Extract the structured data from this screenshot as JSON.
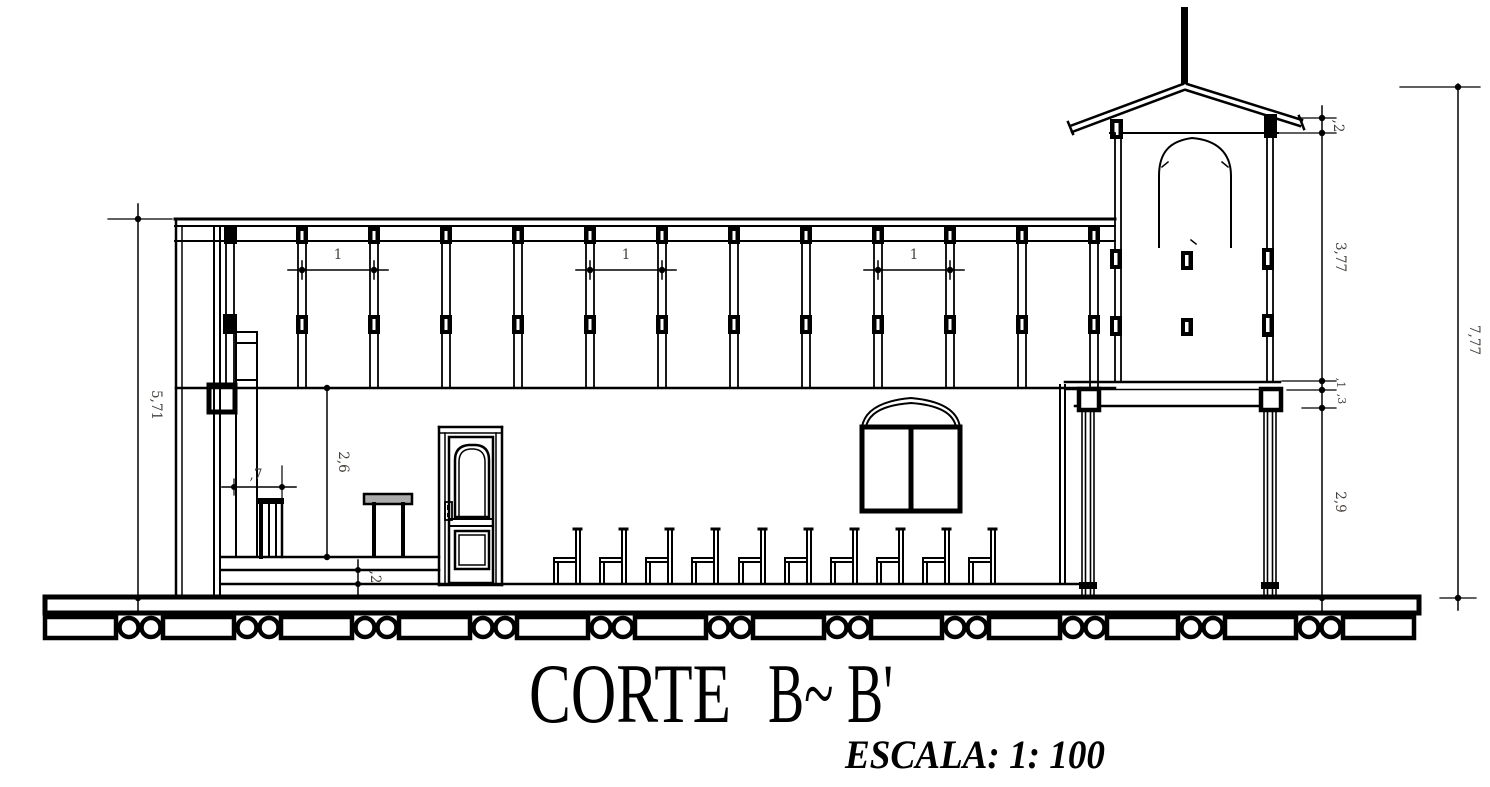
{
  "drawing": {
    "title_main": "CORTE",
    "title_mark": "B~ B'",
    "scale_label": "ESCALA: 1: 100",
    "dims": {
      "nave_height": "5,71",
      "bay_width": "1",
      "lectern_width": ",7",
      "interior_height": "2,6",
      "step_riser": ",2",
      "tower_eave": ",2",
      "tower_upper": "3,77",
      "tower_slab": ",1",
      "tower_beam": ",3",
      "tower_lower": "2,9",
      "overall_height": "7,77"
    },
    "colors": {
      "ink": "#000000",
      "dim_text": "#46413a",
      "altar_top": "#ababab",
      "paper": "#ffffff"
    }
  }
}
